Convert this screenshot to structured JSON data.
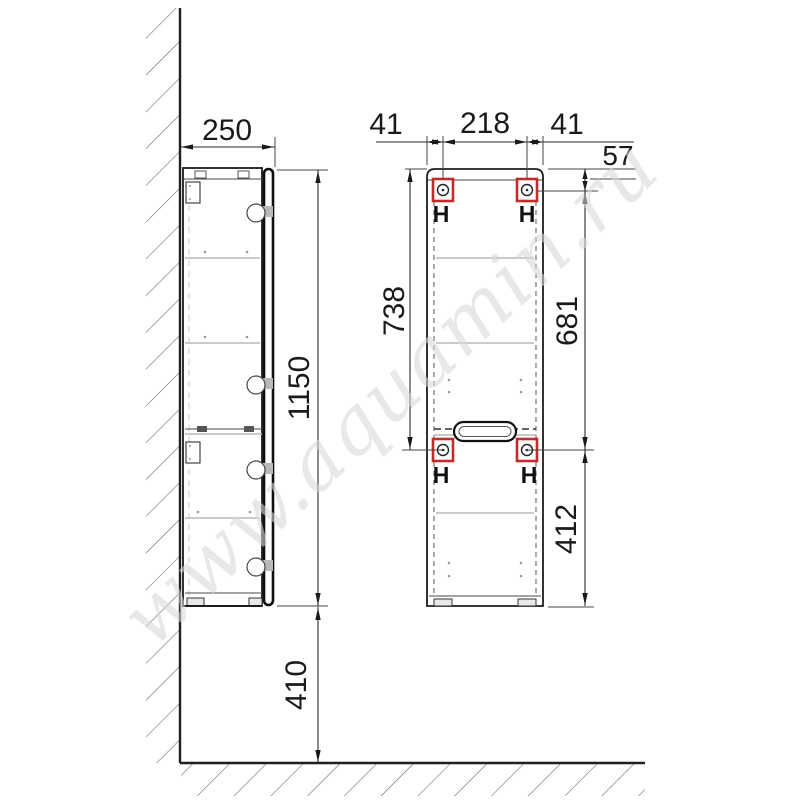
{
  "watermark": "www.aquamin.ru",
  "colors": {
    "red": "#c42b2b",
    "ink": "#1a1a1a",
    "shelf_line": "#b8b8b8",
    "hatch": "#6e6e6e",
    "watermark": "#d9d9d9"
  },
  "dims": {
    "side_depth": "250",
    "side_height": "1150",
    "side_floor_clearance": "410",
    "front_left_offset": "41",
    "front_hanger_spacing": "218",
    "front_right_offset": "41",
    "front_top_offset": "57",
    "front_upper_span": "738",
    "front_hanger_span": "681",
    "front_lower_span": "412"
  },
  "hooks": {
    "label": "H"
  }
}
